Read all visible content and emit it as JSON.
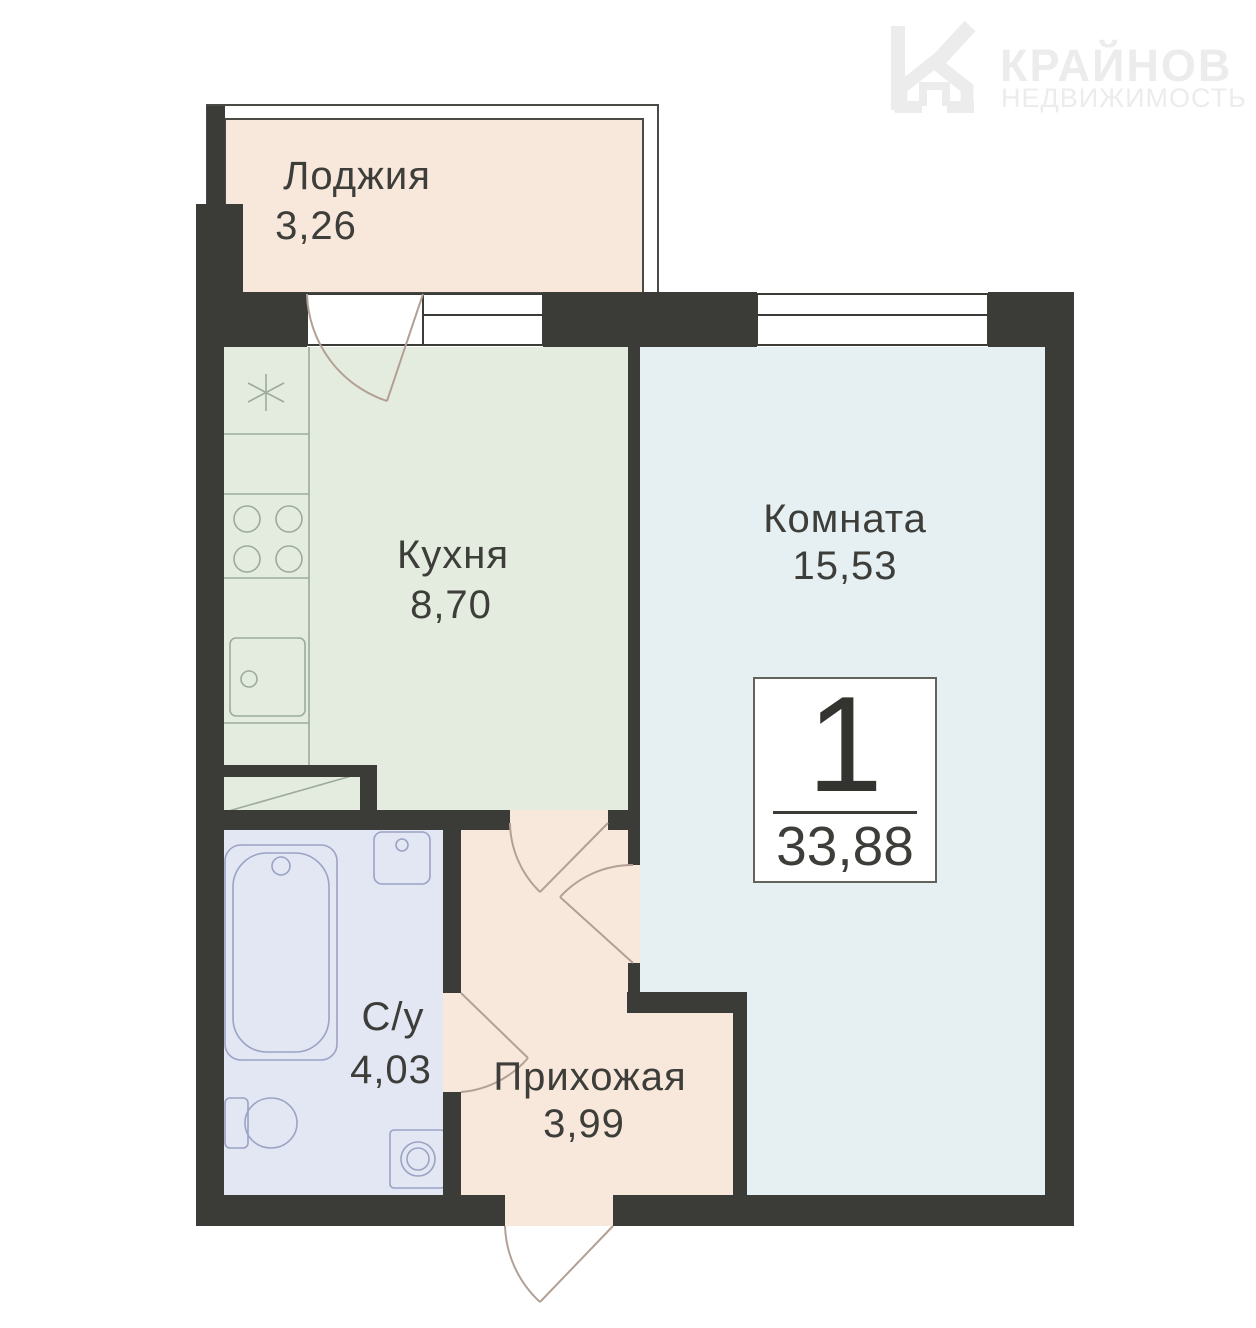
{
  "brand": {
    "name": "КРАЙНОВ",
    "subtitle": "НЕДВИЖИМОСТЬ",
    "logo_icon": "house-k-icon"
  },
  "apartment": {
    "rooms_count": "1",
    "total_area": "33,88"
  },
  "rooms": {
    "loggia": {
      "name": "Лоджия",
      "area": "3,26"
    },
    "kitchen": {
      "name": "Кухня",
      "area": "8,70"
    },
    "living": {
      "name": "Комната",
      "area": "15,53"
    },
    "bathroom": {
      "name": "С/у",
      "area": "4,03"
    },
    "hallway": {
      "name": "Прихожая",
      "area": "3,99"
    }
  },
  "colors": {
    "wall": "#3b3b37",
    "loggia": "#f8e8dc",
    "kitchen": "#e4ecdf",
    "living": "#e6eff1",
    "bathroom": "#e3e7f4",
    "hallway": "#f8e8dc",
    "glazing_line": "#4a4a46",
    "kitchen_line": "#9cab9c",
    "bath_line": "#9aa3c4",
    "door_line": "#b3a095",
    "logo": "#ececec",
    "text": "#3d3d39"
  }
}
